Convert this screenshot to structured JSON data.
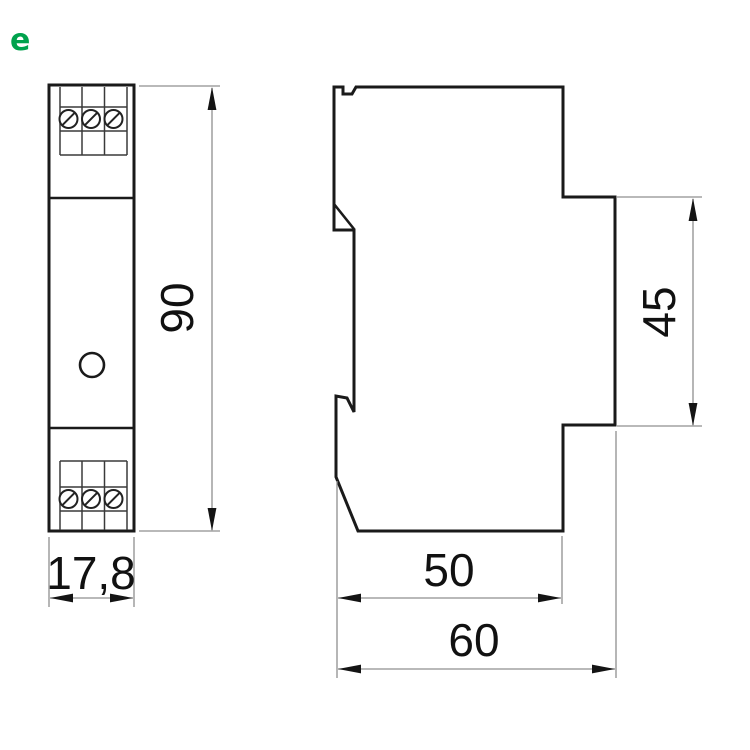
{
  "logo": {
    "letter": "e",
    "color": "#00A24D"
  },
  "drawing_title": "DIN-rail module dimension drawing",
  "dimensions": {
    "front_height_mm": "90",
    "front_width_mm": "17,8",
    "side_rail_section_mm": "45",
    "side_body_depth_mm": "50",
    "side_total_depth_mm": "60"
  },
  "colors": {
    "outline": "#1a1a1a",
    "dimension_lines": "#8f8f8f",
    "text": "#111111"
  }
}
